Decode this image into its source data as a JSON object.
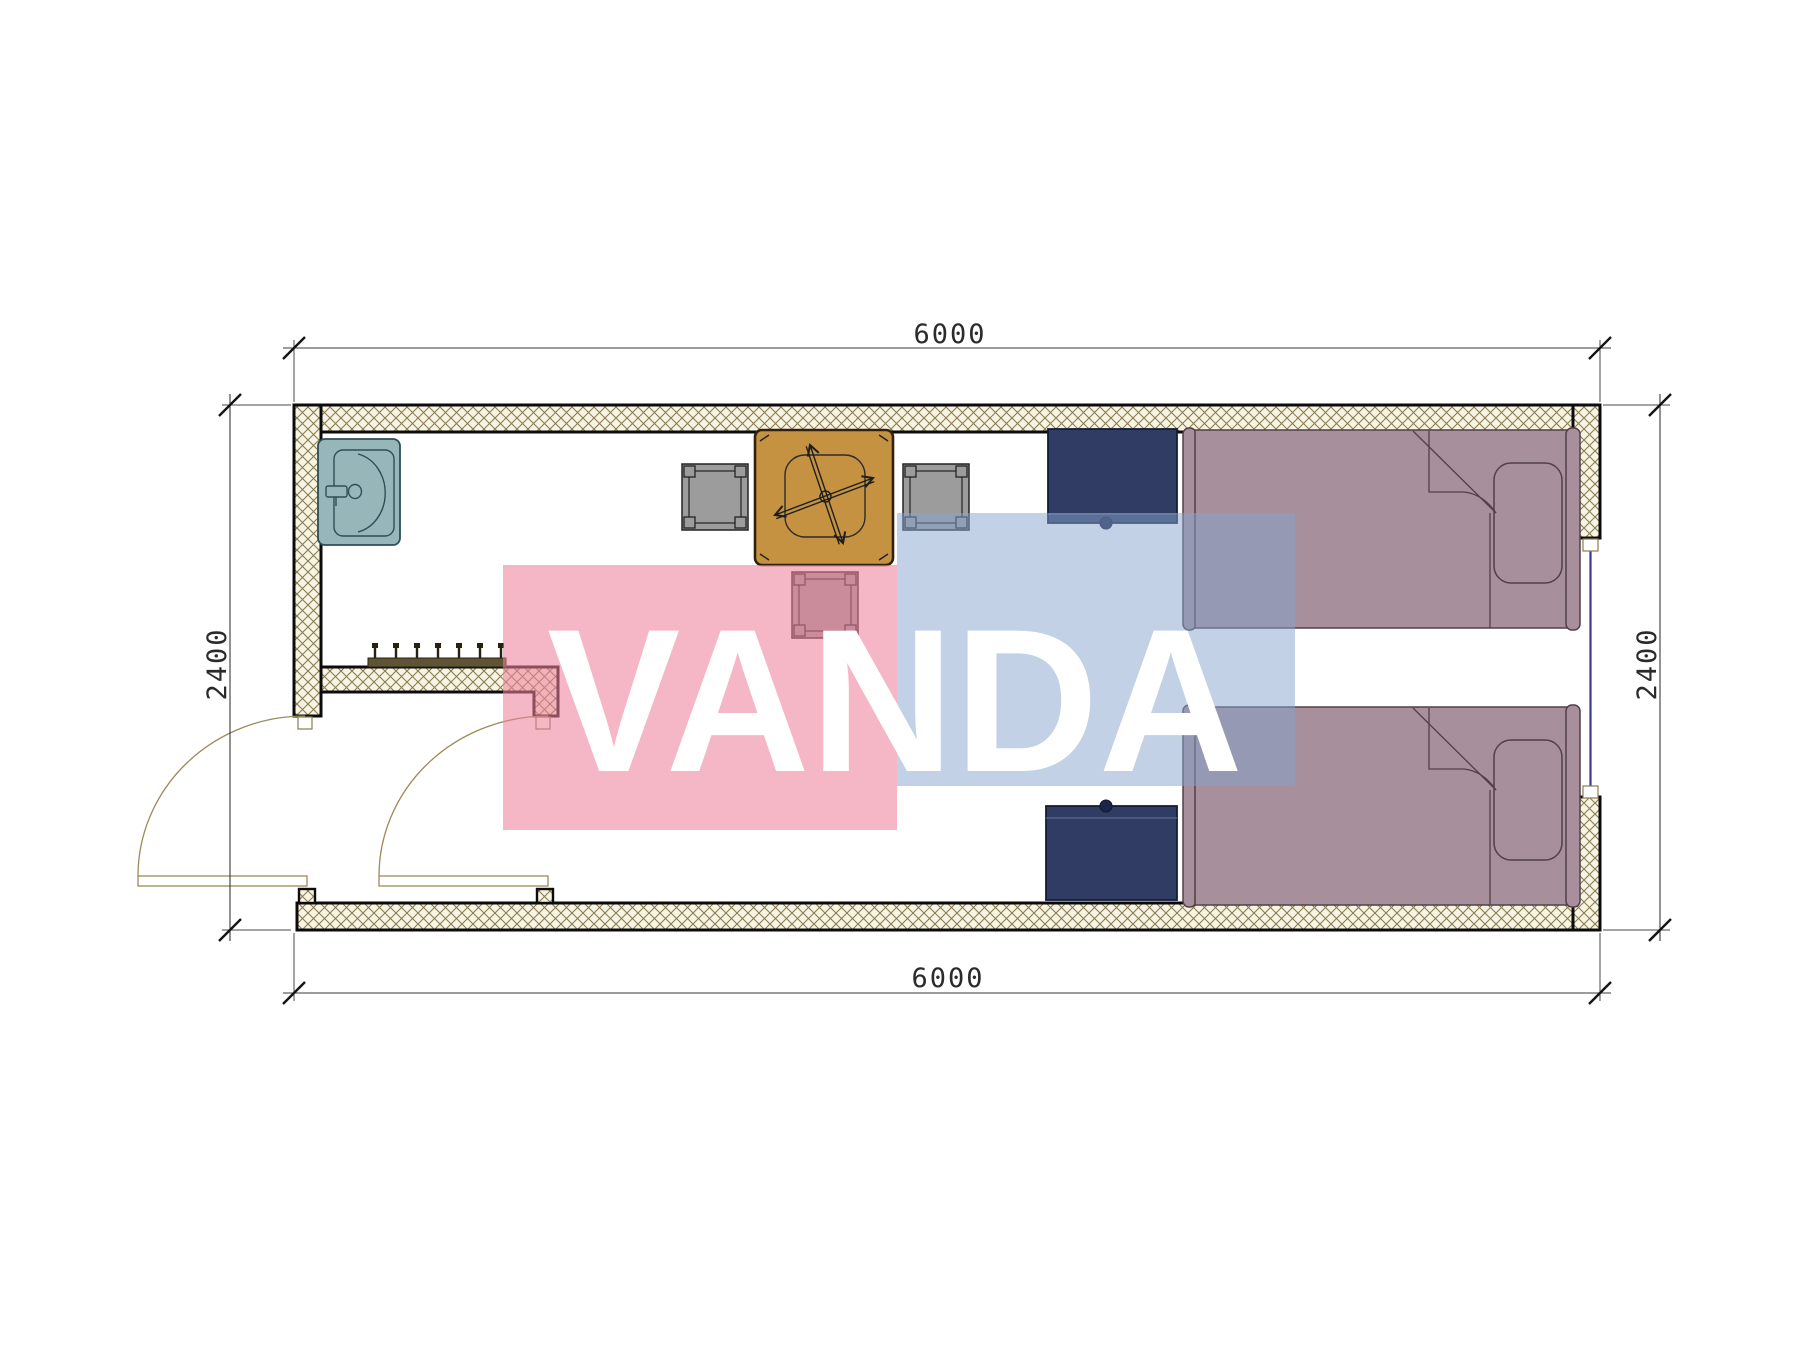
{
  "drawing": {
    "kind": "floor-plan",
    "room_outer_width_mm": 6000,
    "room_outer_depth_mm": 2400
  },
  "dimensions": {
    "top": "6000",
    "bottom": "6000",
    "left": "2400",
    "right": "2400"
  },
  "watermark": {
    "text": "VANDA",
    "pink_color": "#ee809b",
    "blue_color": "#86a4cb"
  },
  "colors": {
    "wall_hatch_line": "#8a7c52",
    "wall_hatch_bg": "#f8f4e3",
    "wall_outline": "#0c0c0c",
    "sink": "#97b6ba",
    "table": "#c59241",
    "chair": "#9c9c9c",
    "cabinet": "#303c64",
    "bed": "#a78f9b",
    "window_glazing": "#3a3d8f",
    "door_arc": "#9c8a58"
  },
  "furniture": [
    {
      "name": "sink",
      "count": 1
    },
    {
      "name": "coat-rack",
      "hooks": 7
    },
    {
      "name": "dining-table",
      "count": 1
    },
    {
      "name": "chair",
      "count": 3
    },
    {
      "name": "nightstand",
      "count": 2
    },
    {
      "name": "single-bed",
      "count": 2
    },
    {
      "name": "door",
      "count": 2
    },
    {
      "name": "window",
      "count": 1
    }
  ]
}
